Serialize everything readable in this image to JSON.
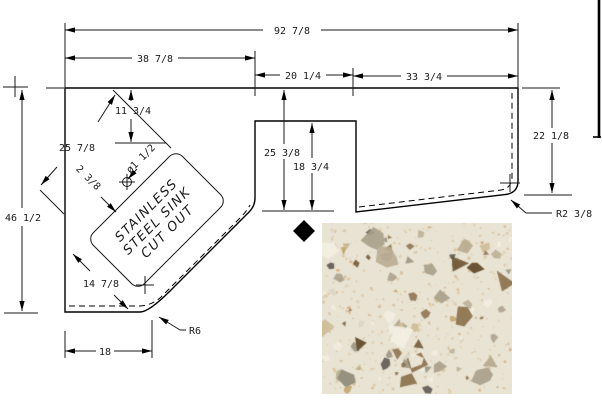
{
  "drawing": {
    "sink_label": {
      "line1": "STAINLESS",
      "line2": "STEEL SINK",
      "line3": "CUT OUT"
    },
    "dims": {
      "overall_width": "92 7/8",
      "left_section_width": "38 7/8",
      "range_opening_width": "20 1/4",
      "right_section_width": "33 3/4",
      "right_depth": "22 1/8",
      "left_depth": "46 1/2",
      "mid_depth": "25 3/8",
      "range_opening_depth": "18 3/4",
      "sink_length": "25 7/8",
      "sink_width": "14 7/8",
      "sink_back_offset": "11 3/4",
      "faucet_hole_offset": "2 3/8",
      "faucet_hole_dia": "ø1 1/2",
      "bottom_width": "18",
      "front_corner_radius": "R6",
      "right_corner_radius": "R2 3/8"
    },
    "line_color": "#000000"
  },
  "material": {
    "marker": "diamond",
    "base_color": "#e9e3d3",
    "chip_colors": [
      "#cbbb92",
      "#b9ad93",
      "#a99f8b",
      "#8a6f49",
      "#6b5434",
      "#f3efe2",
      "#c2a36b",
      "#55514a",
      "#97927f",
      "#d9d3c2"
    ],
    "dot_colors": [
      "#d8b98c",
      "#caa26b",
      "#c98f55"
    ]
  }
}
